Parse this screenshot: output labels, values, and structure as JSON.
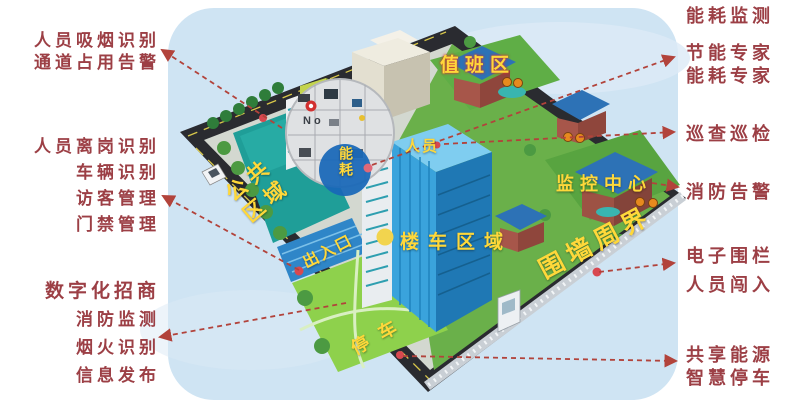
{
  "colors": {
    "label_red": "#9C3F45",
    "arrow_red": "#B2433B",
    "scene_label_yellow": "#FFD83A",
    "sky_blue": "#CFE4F3",
    "plaza_teal": "#1F9E98",
    "lawn_green": "#8ED14C",
    "main_building_blue": "#3AA3DC",
    "roof_blue": "#2D72B6"
  },
  "annotations": {
    "left": [
      {
        "lines": [
          "人员吸烟识别",
          "通道占用告警"
        ]
      },
      {
        "lines": [
          "人员离岗识别",
          "车辆识别",
          "访客管理",
          "门禁管理"
        ]
      },
      {
        "lines": [
          "数字化招商",
          "消防监测",
          "烟火识别",
          "信息发布"
        ]
      }
    ],
    "right": [
      {
        "lines": [
          "能耗监测"
        ]
      },
      {
        "lines": [
          "节能专家",
          "能耗专家"
        ]
      },
      {
        "lines": [
          "巡查巡检"
        ]
      },
      {
        "lines": [
          "消防告警"
        ]
      },
      {
        "lines": [
          "电子围栏",
          "人员闯入"
        ]
      },
      {
        "lines": [
          "共享能源",
          "智慧停车"
        ]
      }
    ]
  },
  "scene": {
    "labels": {
      "duty_area": "值班区",
      "energy_badge": "能耗",
      "personnel": "人员",
      "public_area": "公共区域",
      "monitor_center": "监控中心",
      "building_vehicle_area": "楼车区域",
      "entrance_exit": "出入口",
      "perimeter_wall": "围墙周界",
      "parking": "停车",
      "magnifier_text": "No"
    }
  }
}
